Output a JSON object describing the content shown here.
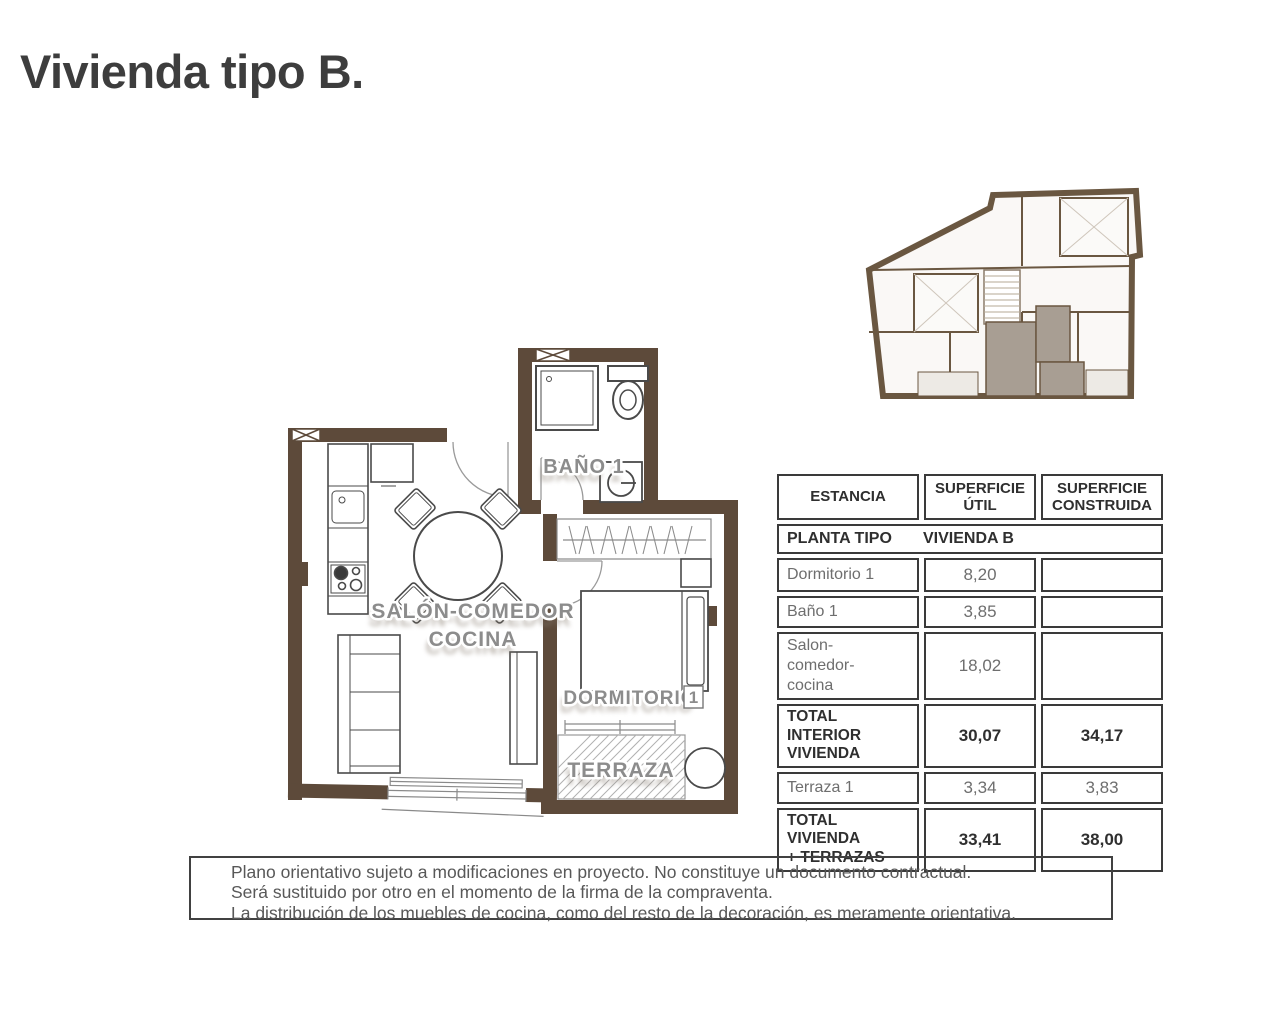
{
  "page": {
    "title": "Vivienda tipo B."
  },
  "floor_plan": {
    "label_bano": "BAÑO 1",
    "label_salon_line1": "SALÓN-COMEDOR",
    "label_salon_line2": "COCINA",
    "label_dormitorio": "DORMITORIO",
    "label_dormitorio_num": "1",
    "label_terraza": "TERRAZA"
  },
  "table": {
    "headers": [
      "ESTANCIA",
      "SUPERFICIE\nÚTIL",
      "SUPERFICIE\nCONSTRUIDA"
    ],
    "subheader_left": "PLANTA TIPO",
    "subheader_right": "VIVIENDA B",
    "rows": [
      {
        "estancia": "Dormitorio 1",
        "util": "8,20",
        "construida": ""
      },
      {
        "estancia": "Baño 1",
        "util": "3,85",
        "construida": ""
      },
      {
        "estancia": "Salon-\ncomedor-\ncocina",
        "util": "18,02",
        "construida": ""
      },
      {
        "estancia": "TOTAL INTERIOR\nVIVIENDA",
        "util": "30,07",
        "construida": "34,17"
      },
      {
        "estancia": "Terraza 1",
        "util": "3,34",
        "construida": "3,83"
      },
      {
        "estancia": "TOTAL VIVIENDA\n+ TERRAZAS",
        "util": "33,41",
        "construida": "38,00"
      }
    ]
  },
  "disclaimer": {
    "lines": [
      "Plano orientativo sujeto a modificaciones en proyecto. No constituye un documento contractual.",
      "Será sustituido por otro en el momento de la firma de la compraventa.",
      "La distribución de los muebles de cocina, como del resto de la decoración, es meramente orientativa."
    ]
  },
  "colors": {
    "wall_brown": "#5d4a3a",
    "minimap_wall": "#6a5741",
    "minimap_highlight": "#a89e93",
    "room_label_gray": "#8c8c8c",
    "table_border": "#3a3a3a",
    "text_dark": "#2f2f2f",
    "text_gray": "#6e6e6e"
  }
}
